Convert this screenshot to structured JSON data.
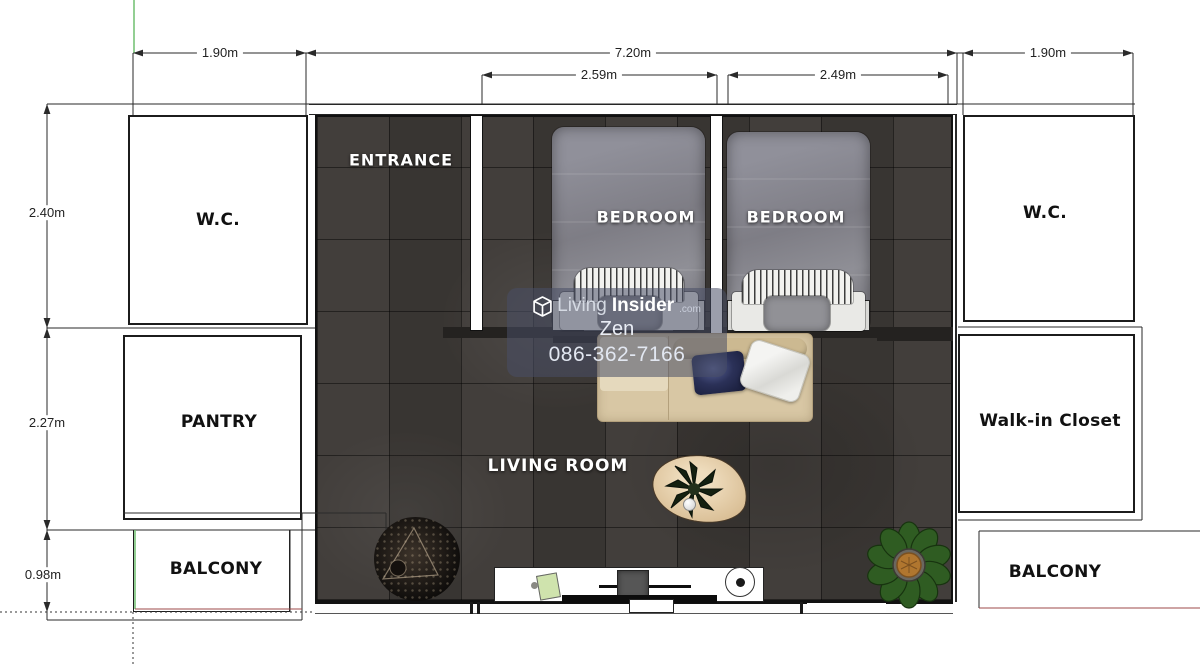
{
  "rooms": {
    "entrance": "ENTRANCE",
    "bedroom_1": "BEDROOM",
    "bedroom_2": "BEDROOM",
    "living_room": "LIVING ROOM",
    "wc_left": "W.C.",
    "wc_right": "W.C.",
    "pantry": "PANTRY",
    "walk_in_closet": "Walk-in Closet",
    "balcony_left": "BALCONY",
    "balcony_right": "BALCONY"
  },
  "dimensions": {
    "top_left": "1.90m",
    "top_center": "7.20m",
    "top_right": "1.90m",
    "bedroom_1_width": "2.59m",
    "bedroom_2_width": "2.49m",
    "left_top": "2.40m",
    "left_middle": "2.27m",
    "left_bottom": "0.98m"
  },
  "watermark": {
    "brand_prefix": "Living",
    "brand_suffix": "Insider",
    "brand_domain": ".com",
    "agent_name": "Zen",
    "phone": "086-362-7166"
  },
  "colors": {
    "floor_tile": "#3c3835",
    "wall_line": "#2a2a2a",
    "accent_green": "#6fbf6f",
    "accent_red": "#9c4a4a",
    "watermark_bg": "rgba(73,78,102,0.55)"
  }
}
